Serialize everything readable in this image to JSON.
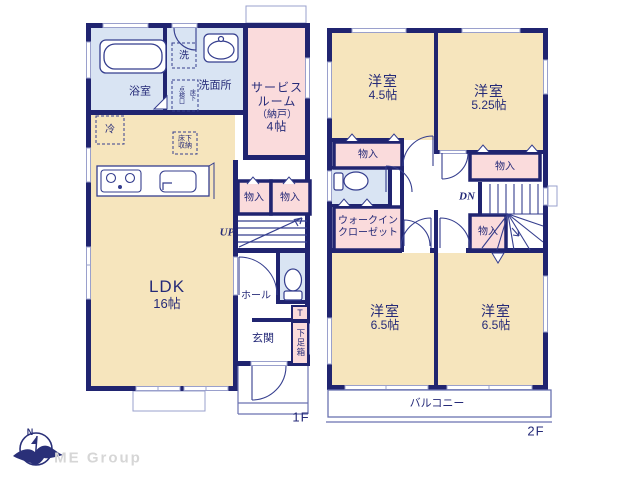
{
  "colors": {
    "wall": "#202470",
    "room_cream": "#f6e5bd",
    "room_pink": "#fadbdc",
    "room_blue": "#d9e4f3",
    "fixture_line": "#353e8e",
    "thin_line": "#9aa0cc",
    "text": "#252a78",
    "logo_gray": "#d6d6d6"
  },
  "logo": {
    "company": "ME Group",
    "compass_letter": "N"
  },
  "floor1": {
    "floor_label": "1F",
    "bath": "浴室",
    "laundry": "洗",
    "washroom": "洗面所",
    "hatch_right": "床下",
    "hatch_left": "点検口",
    "service_room": [
      "サービス",
      "ルーム",
      "（納戸）",
      "4帖"
    ],
    "fridge": "冷",
    "underfloor_storage": [
      "床下",
      "収納"
    ],
    "ldk": [
      "LDK",
      "16帖"
    ],
    "closet1": "物入",
    "closet2": "物入",
    "up": "UP",
    "hall": "ホール",
    "entrance": "玄関",
    "shoe_t": "T",
    "shoe_box": "下足箱"
  },
  "floor2": {
    "floor_label": "2F",
    "bedroom1": [
      "洋室",
      "4.5帖"
    ],
    "bedroom2": [
      "洋室",
      "5.25帖"
    ],
    "closet_a": "物入",
    "closet_b": "物入",
    "closet_c": "物入",
    "wic": [
      "ウォークイン",
      "クローゼット"
    ],
    "dn": "DN",
    "bedroom3": [
      "洋室",
      "6.5帖"
    ],
    "bedroom4": [
      "洋室",
      "6.5帖"
    ],
    "balcony": "バルコニー"
  }
}
